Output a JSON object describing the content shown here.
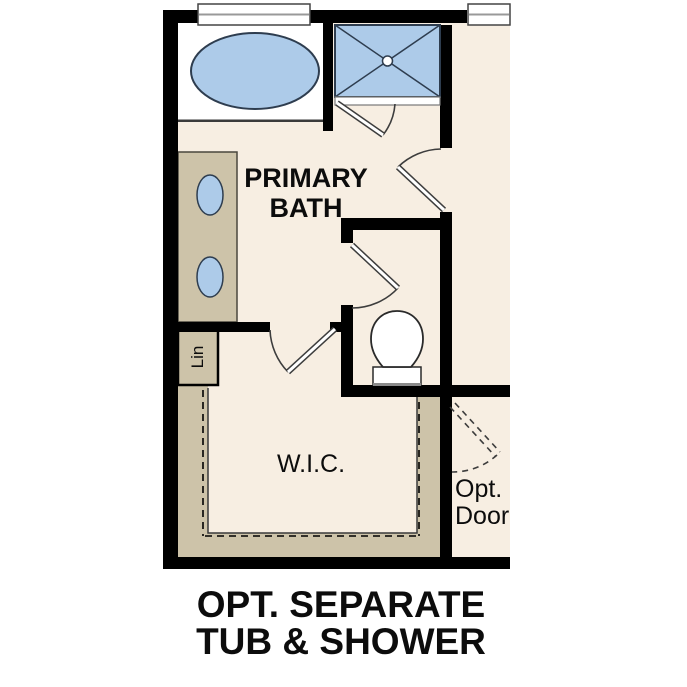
{
  "figure": {
    "type": "floor-plan-option-diagram",
    "caption": {
      "line1": "OPT. SEPARATE",
      "line2": "TUB & SHOWER"
    },
    "rooms": {
      "primary_bath": {
        "label_line1": "PRIMARY",
        "label_line2": "BATH"
      },
      "walk_in_closet": {
        "label": "W.I.C."
      },
      "linen_closet": {
        "label": "Lin"
      },
      "optional_door": {
        "label_line1": "Opt.",
        "label_line2": "Door"
      }
    },
    "fixtures": [
      "bathtub",
      "shower",
      "double-vanity-sinks",
      "toilet",
      "windows",
      "closet-shelving"
    ],
    "colors": {
      "wall": "#000000",
      "floor": "#f7eee2",
      "cabinet": "#cdc3a9",
      "fixture": "#adcbe9",
      "fixtureline": "#2e3d4f",
      "paper": "#ffffff"
    }
  }
}
